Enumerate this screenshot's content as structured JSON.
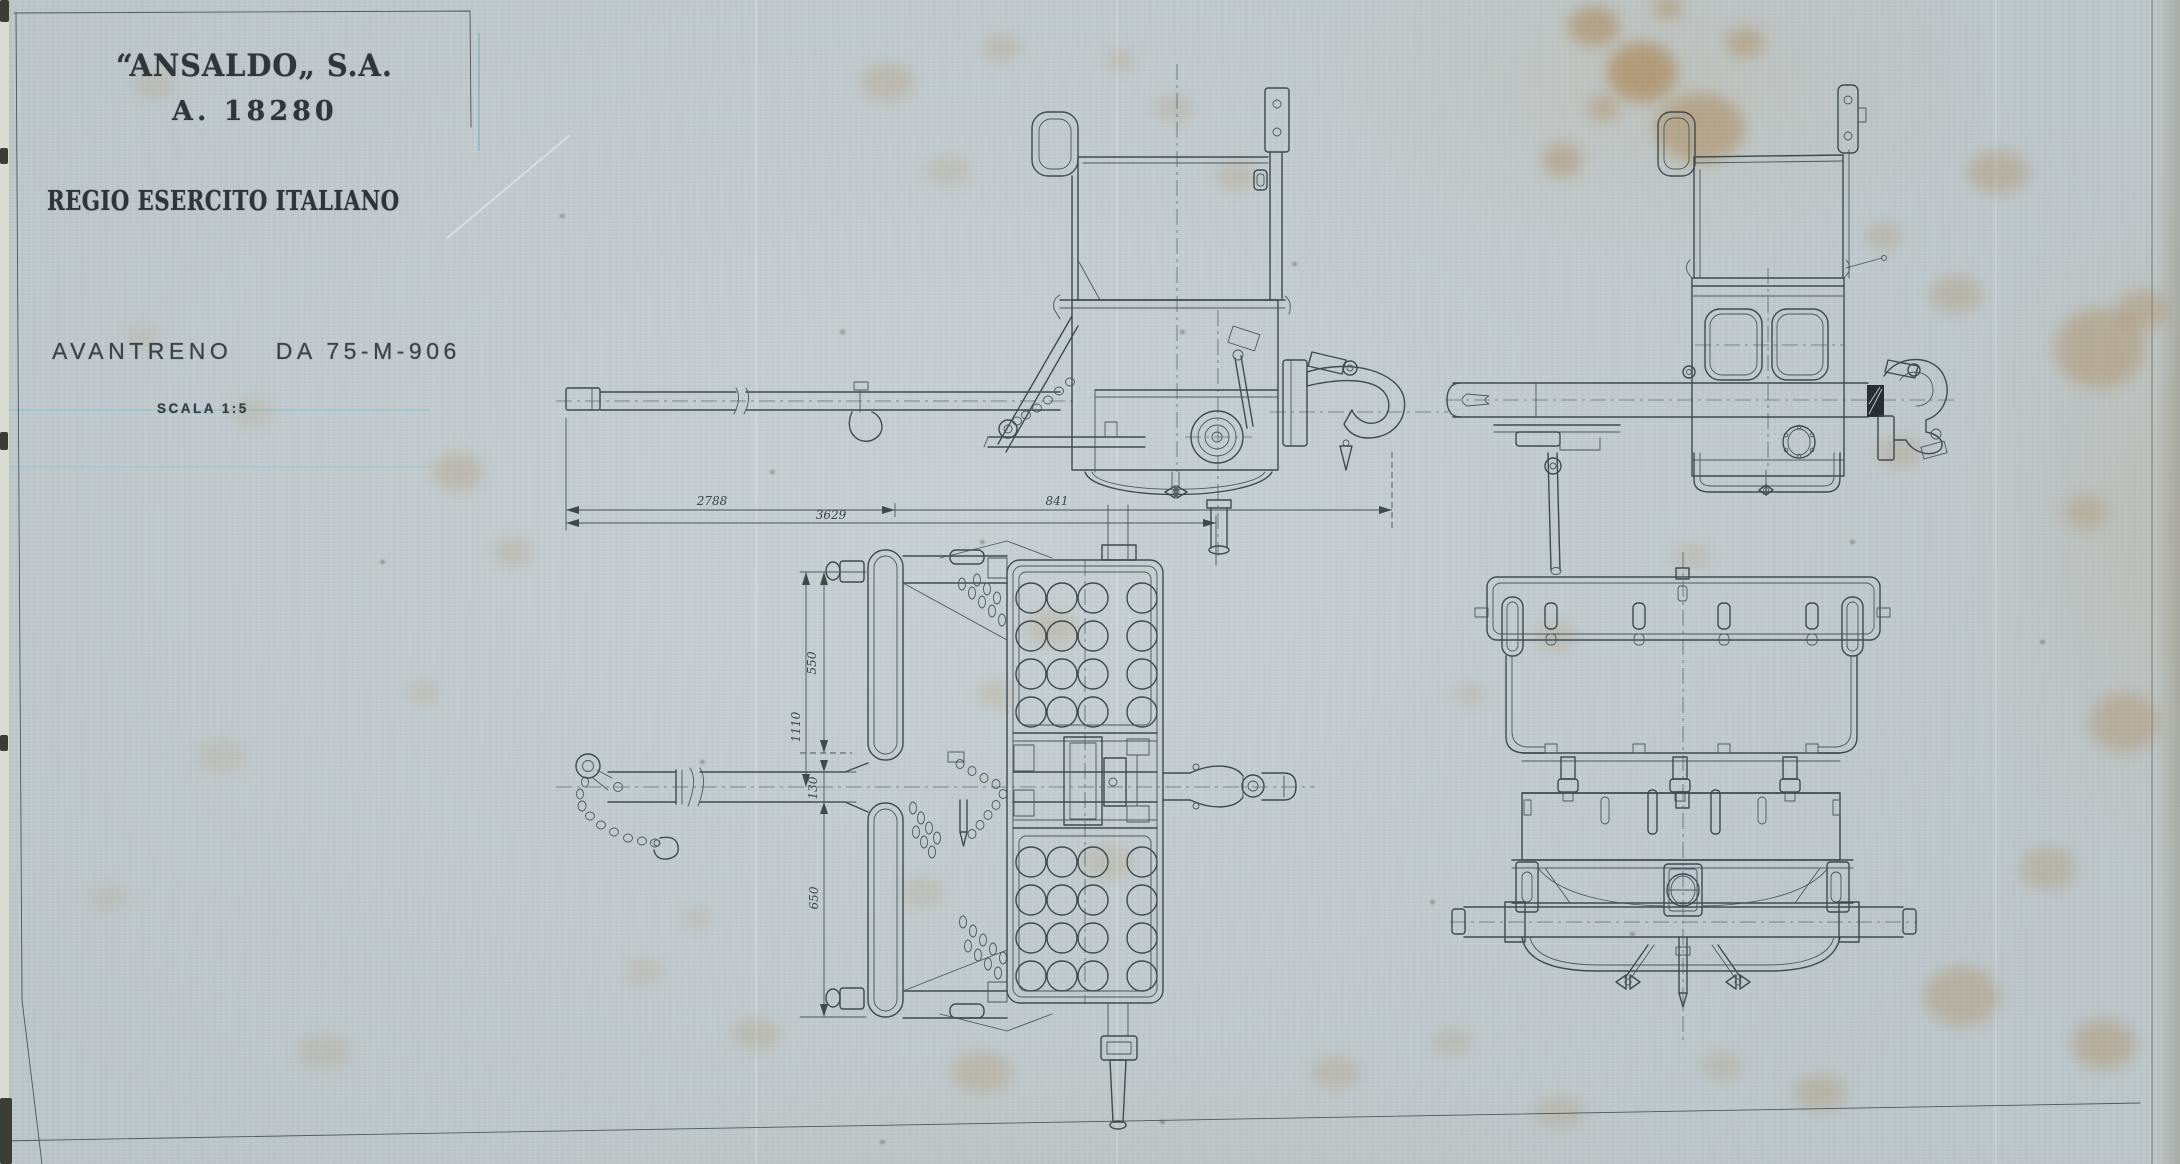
{
  "sheet": {
    "paper_color": "#c5ced1",
    "ink_color": "#3e4a4f",
    "stain_color": "#a5763a"
  },
  "title_block": {
    "company": "“ANSALDO„ S.A.",
    "drawing_number": "A. 18280",
    "client": "REGIO ESERCITO ITALIANO",
    "subject": "AVANTRENO    DA 75-M-906",
    "scale_label": "SCALA 1:5"
  },
  "dimensions": {
    "horizontal": {
      "segment_left": "2788",
      "segment_right": "841",
      "overall": "3629"
    },
    "vertical": {
      "upper": "550",
      "overall": "1110",
      "pole_width": "130",
      "lower": "650"
    }
  }
}
